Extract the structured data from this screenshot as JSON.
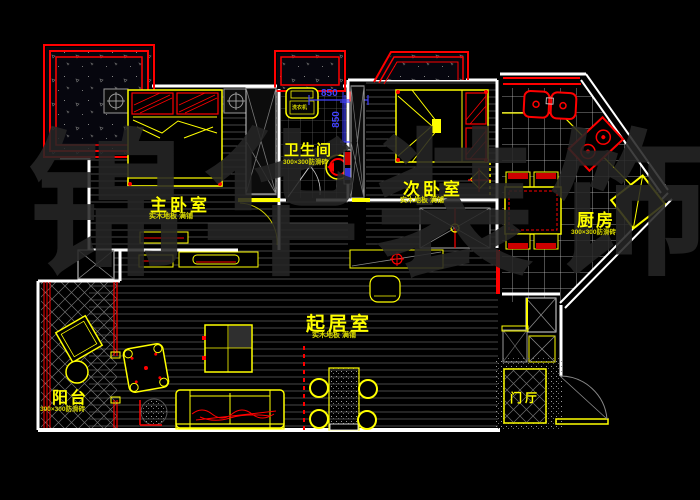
{
  "title": "apartment-floor-plan",
  "watermark": {
    "text": "锦华装饰"
  },
  "rooms": {
    "master": {
      "label": "主卧室",
      "sublabel": "实木地板 满铺"
    },
    "bathroom": {
      "label": "卫生间",
      "sublabel": "300×300防滑砖"
    },
    "second": {
      "label": "次卧室",
      "sublabel": "实木地板 满铺"
    },
    "kitchen": {
      "label": "厨房",
      "sublabel": "300×300防滑砖"
    },
    "living": {
      "label": "起居室",
      "sublabel": "实木地板 满铺"
    },
    "balcony": {
      "label": "阳台",
      "sublabel": "300×300防滑砖"
    },
    "foyer": {
      "label": "门厅"
    }
  },
  "dimensions": {
    "horizontal": "850",
    "vertical": "850"
  },
  "appliances": {
    "washer": "洗衣机"
  },
  "colors": {
    "wall": "#ffffff",
    "furniture": "#ffff00",
    "accent": "#ff0000",
    "dimension": "#4343ff",
    "background": "#000000",
    "watermark_gray": "#262626"
  }
}
